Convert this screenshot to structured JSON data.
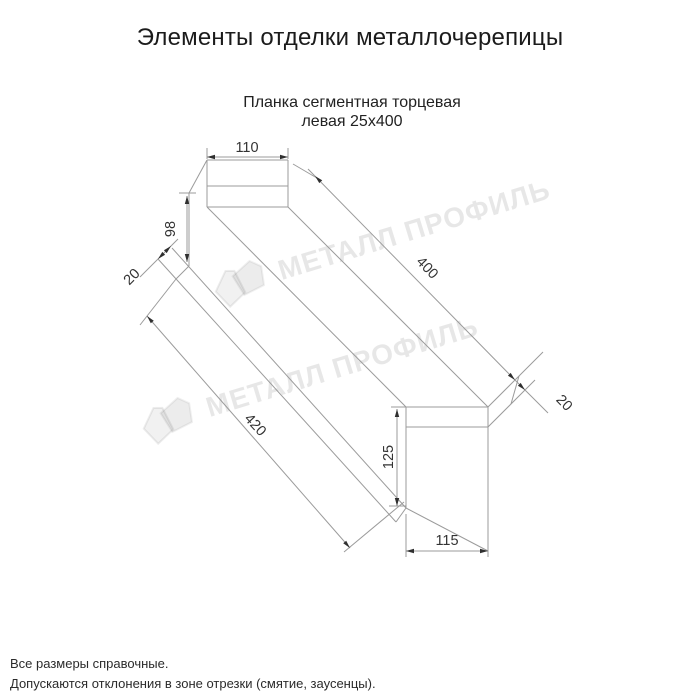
{
  "page": {
    "title": "Элементы отделки металлочерепицы"
  },
  "product": {
    "subtitle_line1": "Планка сегментная торцевая",
    "subtitle_line2": "левая 25х400"
  },
  "dimensions": {
    "top_width": "110",
    "left_end_height": "98",
    "left_fold": "20",
    "top_length": "400",
    "right_fold": "20",
    "bottom_length": "420",
    "right_end_height": "125",
    "bottom_width": "115"
  },
  "watermark": {
    "text": "МЕТАЛЛ ПРОФИЛЬ"
  },
  "footer": {
    "line1": "Все размеры справочные.",
    "line2": "Допускаются отклонения в зоне отрезки (смятие, заусенцы)."
  },
  "colors": {
    "line": "#9b9b9b",
    "arrow": "#2f2f2f",
    "dimtext": "#333333",
    "maintext": "#1b1b1b"
  }
}
